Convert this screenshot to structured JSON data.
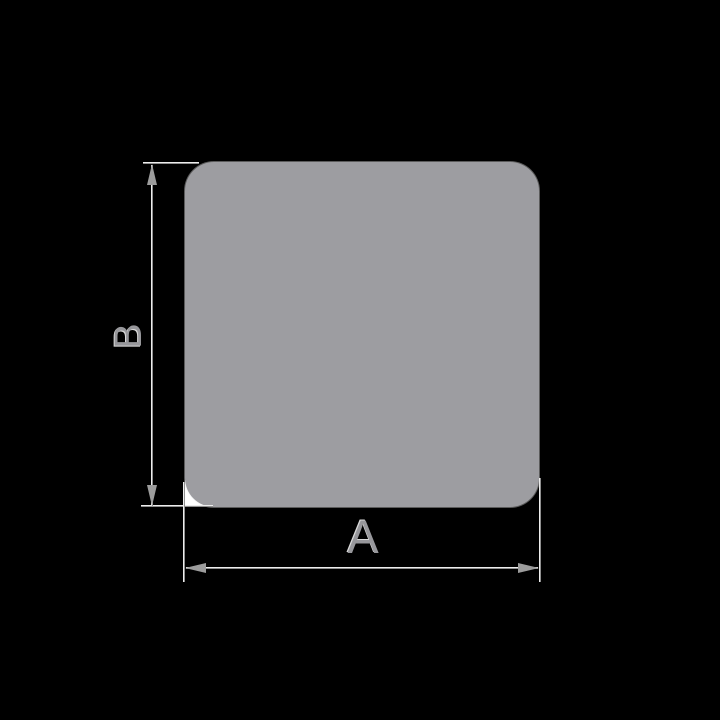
{
  "diagram": {
    "description": "Dimension drawing of a rounded square profile",
    "background_color": "#000000",
    "shape": {
      "type": "rounded-square",
      "fill_color": "#9d9da1",
      "edge_highlight_color": "#ededed",
      "corner_patch_color": "#ffffff"
    },
    "dimension_style": {
      "line_light_color": "#ededed",
      "line_dark_color": "#8f8f8f",
      "arrow_color": "#9c9c9c",
      "label_color": "#97979b"
    },
    "dimensions": {
      "horizontal": {
        "label": "A"
      },
      "vertical": {
        "label": "B"
      }
    }
  }
}
